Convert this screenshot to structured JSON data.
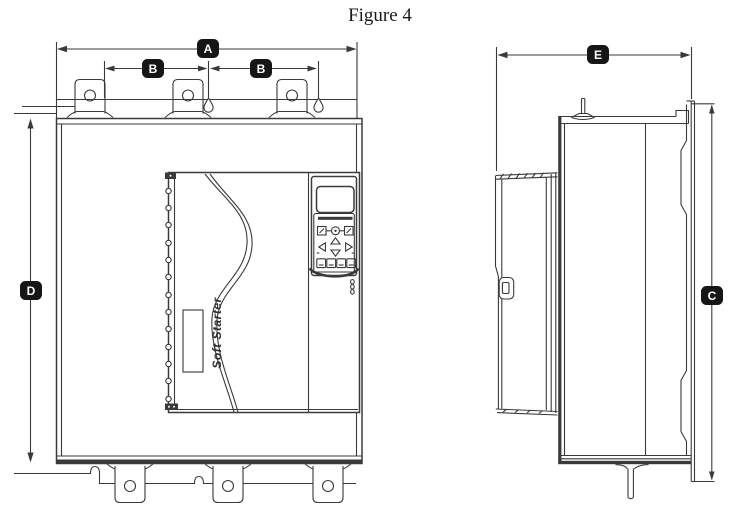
{
  "figure": {
    "title": "Figure 4"
  },
  "views": {
    "front": {
      "brand_label": "Soft Starter"
    },
    "side": {}
  },
  "dimensions": {
    "a": "A",
    "b_left": "B",
    "b_right": "B",
    "c": "C",
    "d": "D",
    "e": "E"
  },
  "colors": {
    "line": "#3a3a3a",
    "badge_background": "#161616",
    "badge_text": "#ffffff",
    "page_background": "#ffffff"
  }
}
